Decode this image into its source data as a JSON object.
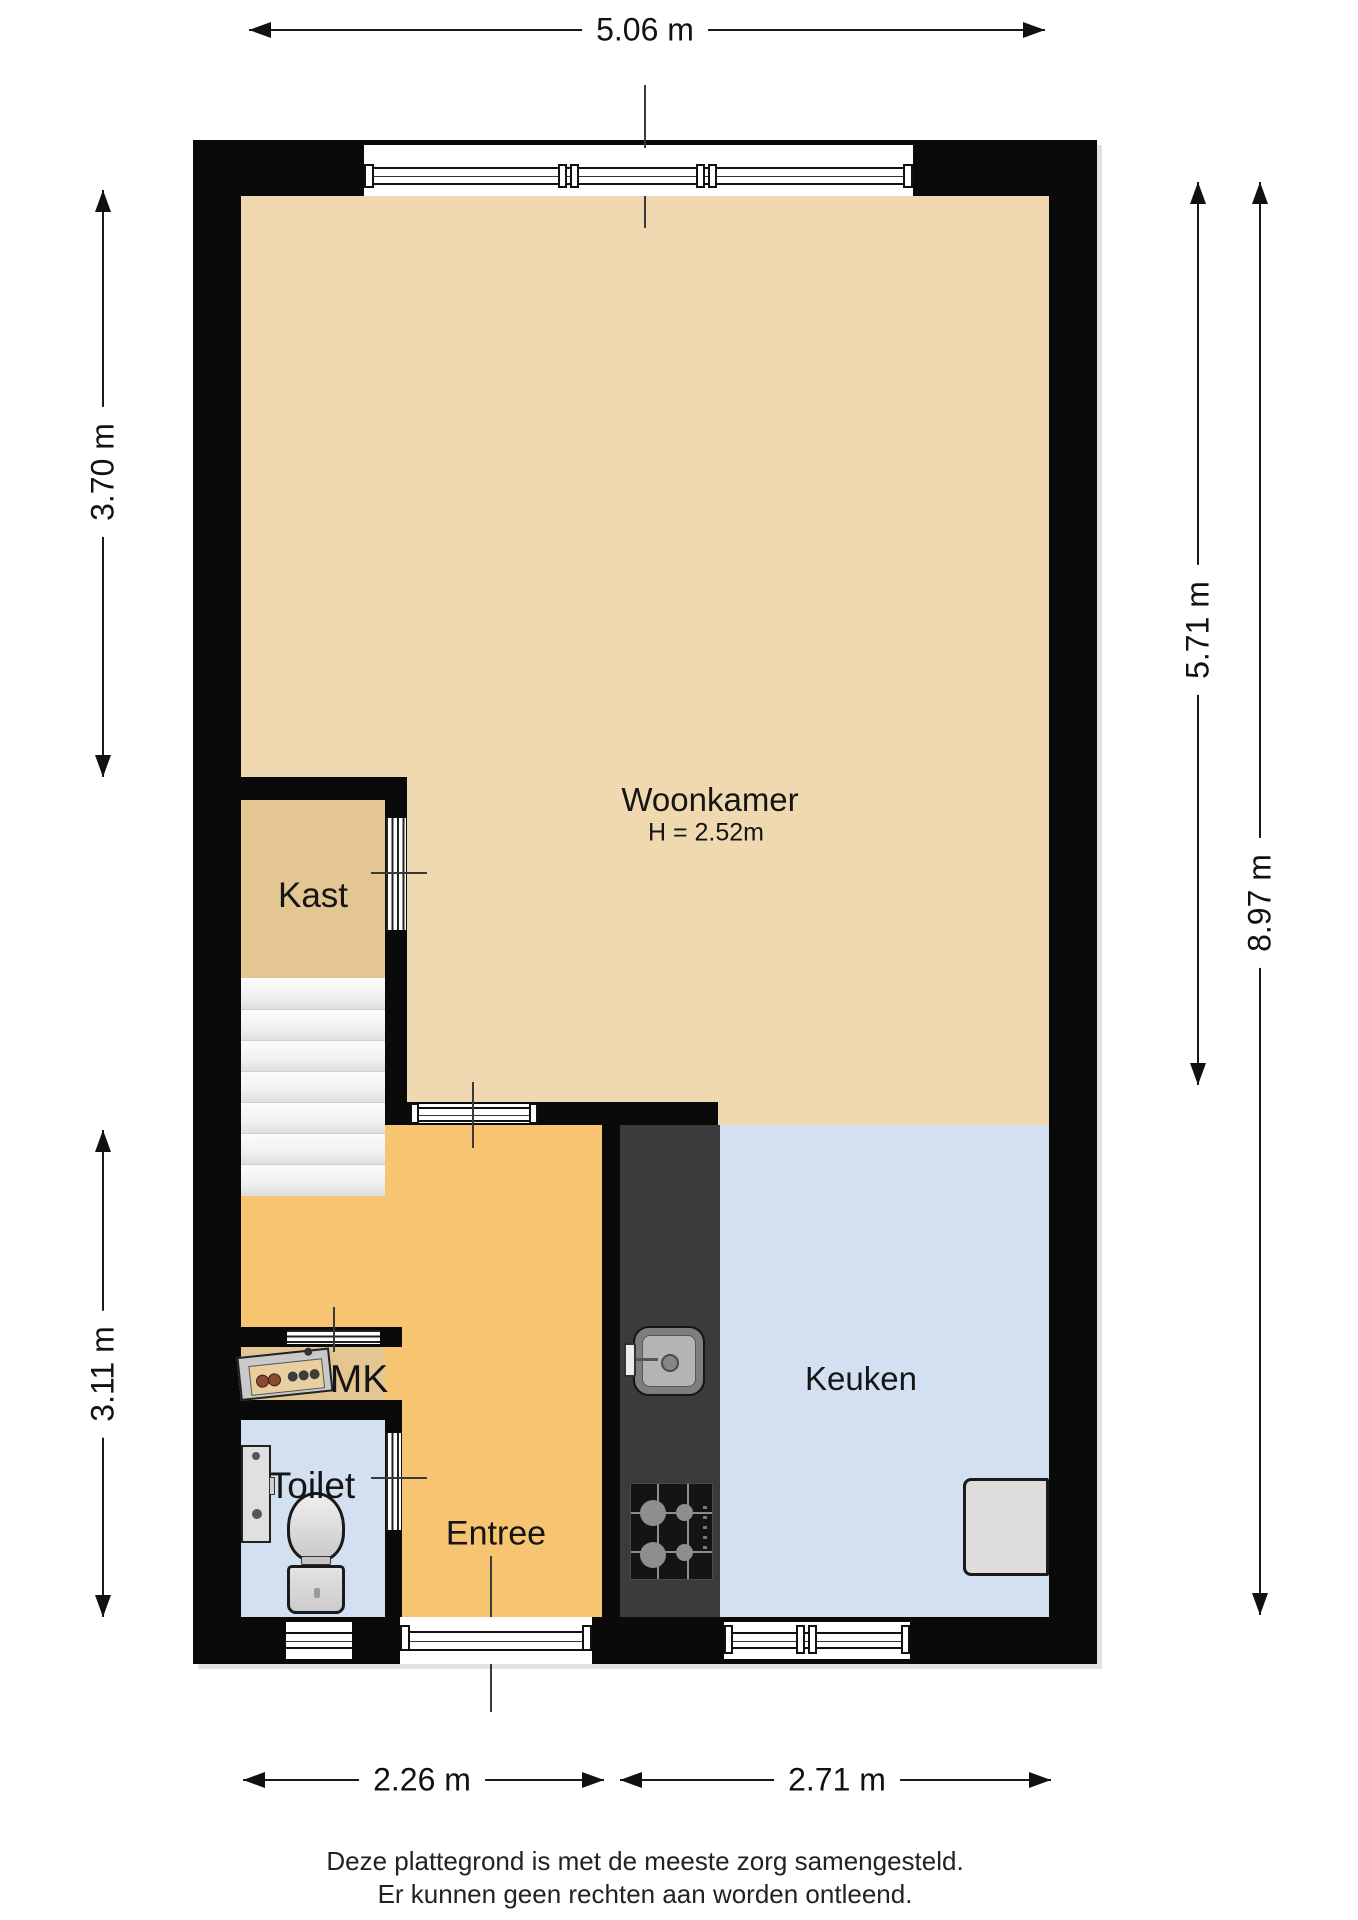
{
  "dimensions": {
    "top_width": "5.06 m",
    "left_upper": "3.70 m",
    "left_lower": "3.11 m",
    "right_inner": "5.71 m",
    "right_total": "8.97 m",
    "bottom_left": "2.26 m",
    "bottom_right": "2.71 m"
  },
  "rooms": {
    "woonkamer": {
      "label": "Woonkamer",
      "ceiling_height": "H = 2.52m"
    },
    "kast": {
      "label": "Kast"
    },
    "mk": {
      "label": "MK"
    },
    "toilet": {
      "label": "Toilet"
    },
    "entree": {
      "label": "Entree"
    },
    "keuken": {
      "label": "Keuken"
    }
  },
  "disclaimer": {
    "line1": "Deze plattegrond is met de meeste zorg samengesteld.",
    "line2": "Er kunnen geen rechten aan worden ontleend."
  },
  "colors": {
    "woonkamer": "#f0d9b0",
    "kast": "#e4c693",
    "entree": "#f7c571",
    "keuken": "#d2e0f1",
    "toilet": "#d2e0f1",
    "wall": "#0a0a0a",
    "counter": "#3b3b3d",
    "stairs": "#f7f7f7"
  }
}
